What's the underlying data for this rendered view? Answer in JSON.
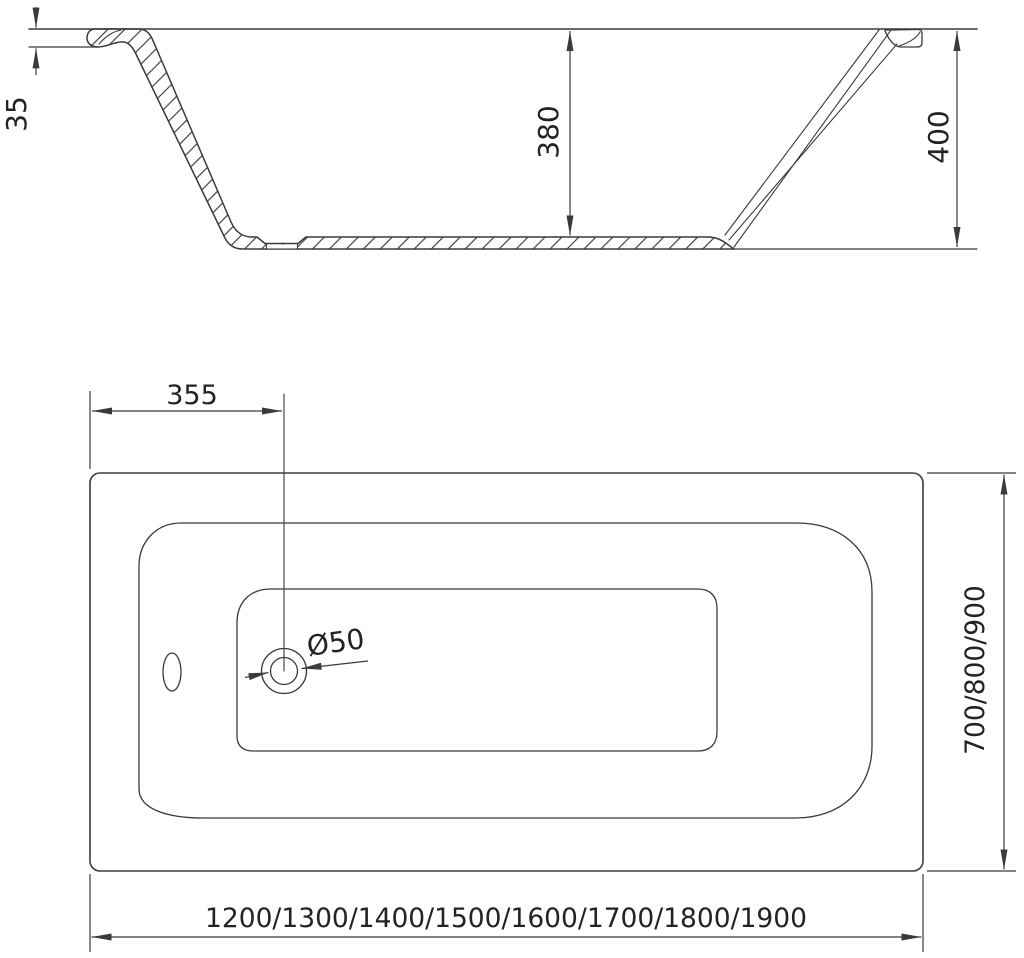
{
  "title": "Bathtub technical dimension drawing",
  "colors": {
    "line": "#3a3a3a",
    "text": "#232323",
    "background": "#ffffff"
  },
  "section_view": {
    "rim_thickness_label": "35",
    "inner_depth_label": "380",
    "overall_height_label": "400"
  },
  "plan_view": {
    "drain_offset_label": "355",
    "drain_diameter_label": "Ø50",
    "width_options_label": "700/800/900",
    "length_options_label": "1200/1300/1400/1500/1600/1700/1800/1900"
  }
}
